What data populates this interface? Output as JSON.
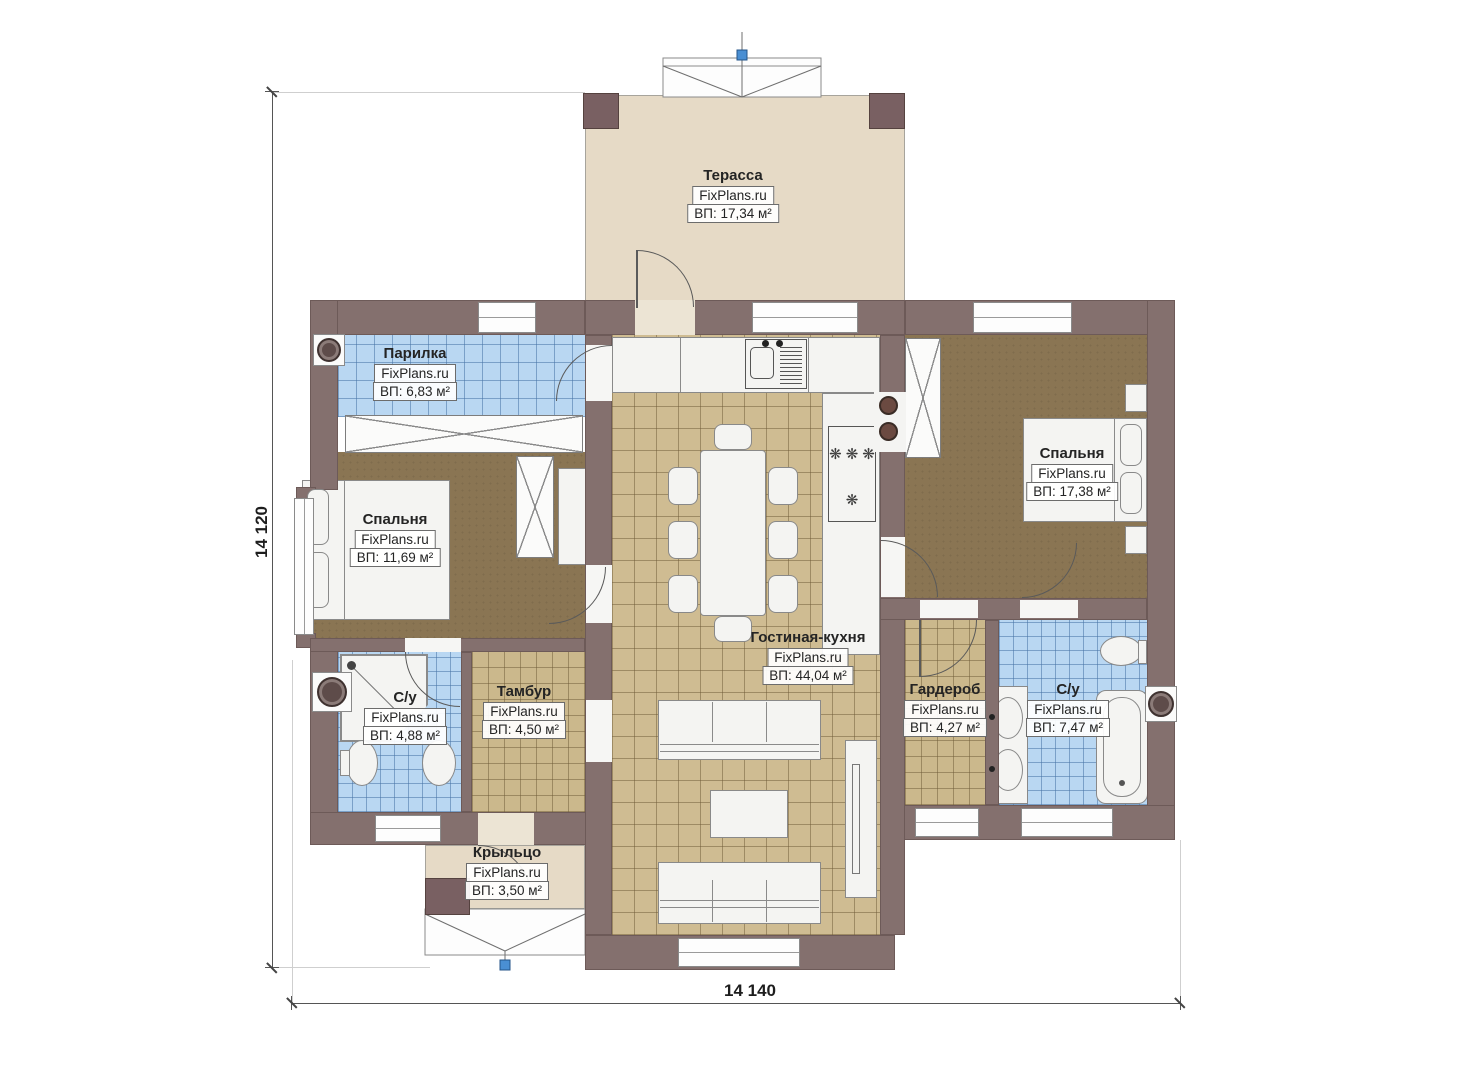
{
  "plan": {
    "dimensions": {
      "height_label": "14 120",
      "width_label": "14 140"
    },
    "rooms": {
      "terrace": {
        "name": "Терасса",
        "brand": "FixPlans.ru",
        "area": "ВП: 17,34 м²"
      },
      "steam_room": {
        "name": "Парилка",
        "brand": "FixPlans.ru",
        "area": "ВП: 6,83 м²"
      },
      "bedroom_left": {
        "name": "Спальня",
        "brand": "FixPlans.ru",
        "area": "ВП: 11,69 м²"
      },
      "bathroom_left": {
        "name": "С/у",
        "brand": "FixPlans.ru",
        "area": "ВП: 4,88 м²"
      },
      "vestibule": {
        "name": "Тамбур",
        "brand": "FixPlans.ru",
        "area": "ВП: 4,50 м²"
      },
      "living_kitchen": {
        "name": "Гостиная-кухня",
        "brand": "FixPlans.ru",
        "area": "ВП: 44,04 м²"
      },
      "bedroom_right": {
        "name": "Спальня",
        "brand": "FixPlans.ru",
        "area": "ВП: 17,38 м²"
      },
      "wardrobe": {
        "name": "Гардероб",
        "brand": "FixPlans.ru",
        "area": "ВП: 4,27 м²"
      },
      "bathroom_right": {
        "name": "С/у",
        "brand": "FixPlans.ru",
        "area": "ВП: 7,47 м²"
      },
      "porch": {
        "name": "Крыльцо",
        "brand": "FixPlans.ru",
        "area": "ВП: 3,50 м²"
      }
    },
    "colors": {
      "wall": "#84706e",
      "wood_floor": "#8a7553",
      "tan_tile": "#cfbc92",
      "blue_tile": "#b9d7f2",
      "terrace_floor": "#e6dac6",
      "marker_blue": "#4a8fd3"
    }
  }
}
